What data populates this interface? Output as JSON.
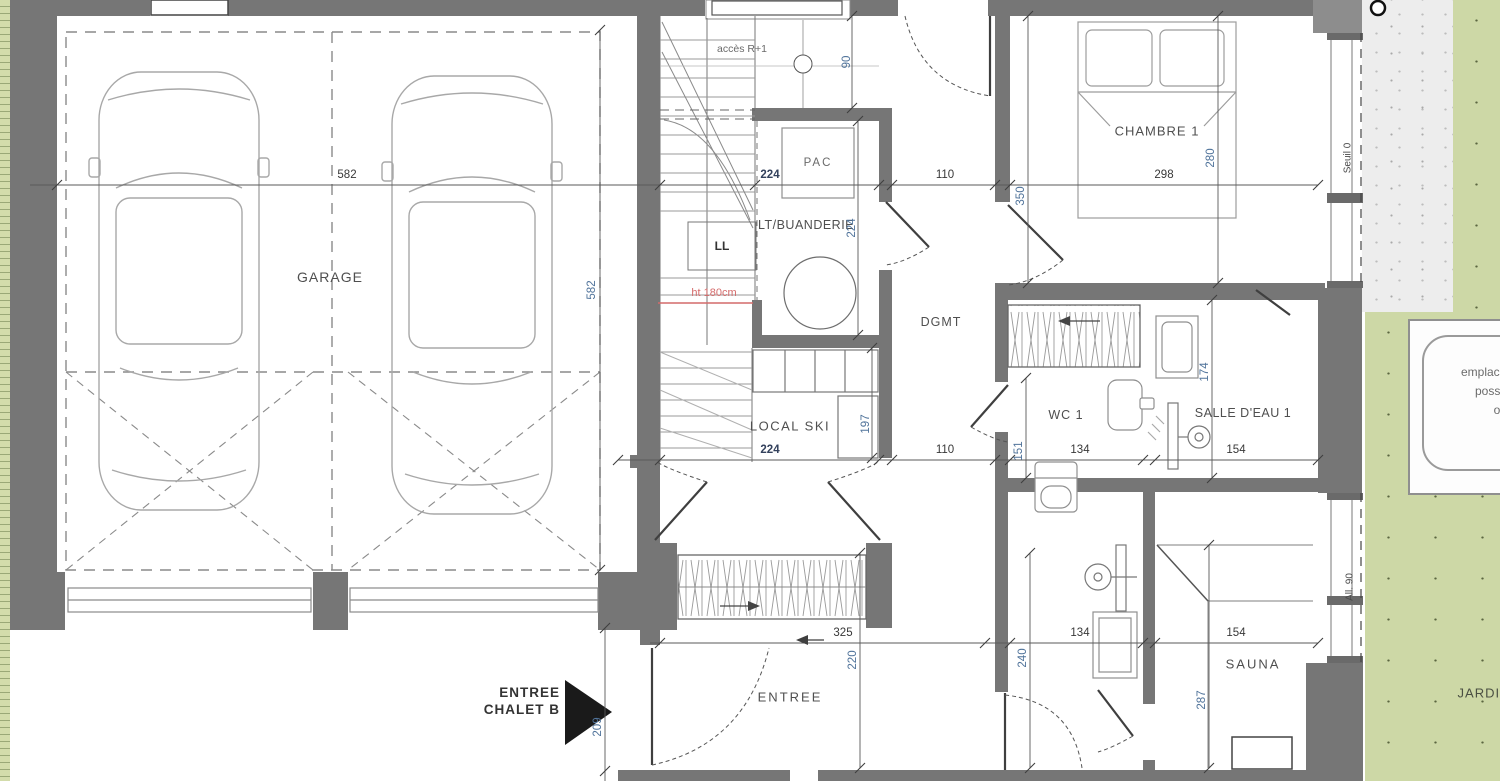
{
  "colors": {
    "wall": "#767676",
    "green_area": "#cdd8a6",
    "green_strip": "#d3dcab",
    "terrace": "#ededed",
    "dim_text": "#33415c",
    "label_text": "#4f4f4f",
    "note_red": "#d46a6a"
  },
  "labels": {
    "garage": "GARAGE",
    "acces_r1": "accès R+1",
    "pac": "PAC",
    "lt_buanderie": "LT/BUANDERIE",
    "ll": "LL",
    "ht_note": "ht 180cm",
    "local_ski": "LOCAL SKI",
    "dgmt": "DGMT",
    "entree": "ENTREE",
    "entree_chalet_1": "ENTREE",
    "entree_chalet_2": "CHALET B",
    "chambre1": "CHAMBRE 1",
    "wc1": "WC 1",
    "salle_eau1": "SALLE D'EAU 1",
    "sauna": "SAUNA",
    "jardin": "JARDIN",
    "seuil": "Seuil 0",
    "allege": "All. 90",
    "emplacement_1": "emplacement",
    "emplacement_2": "possible",
    "emplacement_3": "o"
  },
  "dims": {
    "garage_w": "582",
    "garage_d": "582",
    "stair_top": "90",
    "buanderie_w": "224",
    "buanderie_d": "224",
    "hall_top": "110",
    "chambre_w": "298",
    "chambre_d": "280",
    "chambre_l": "350",
    "ski_w": "224",
    "ski_d": "197",
    "hall_mid": "110",
    "wc_off": "151",
    "wc_w": "134",
    "sde_w": "154",
    "sde_d": "174",
    "closet_w": "325",
    "entree_d": "220",
    "douche_w": "134",
    "sauna_w": "154",
    "douche_d": "240",
    "sauna_d": "287",
    "entry_side": "209"
  }
}
